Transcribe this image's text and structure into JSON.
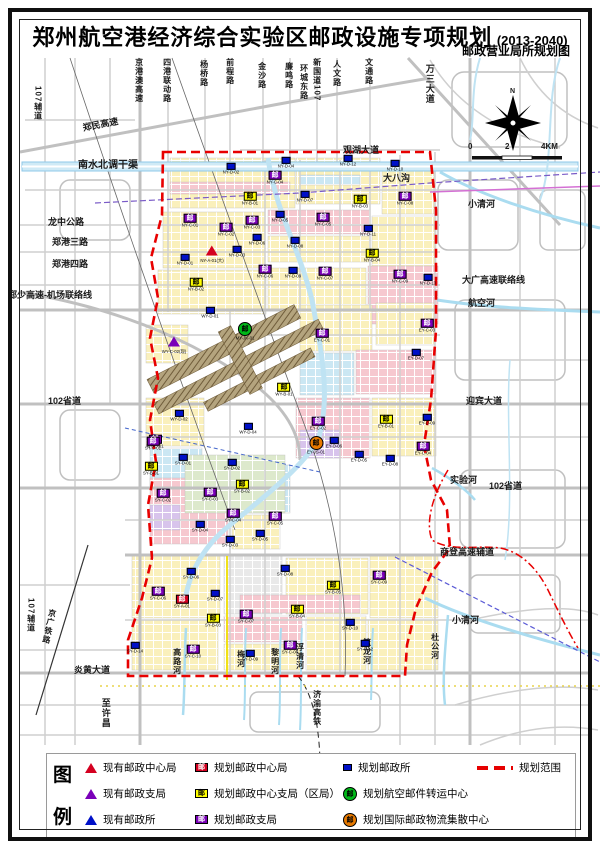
{
  "page": {
    "title": "郑州航空港经济综合实验区邮政设施专项规划",
    "title_years": "(2013-2040)",
    "subtitle": "邮政营业局所规划图"
  },
  "compass": {
    "north_label": "N"
  },
  "scale_bar": {
    "labels": [
      "0",
      "2",
      "4KM"
    ]
  },
  "colors": {
    "existing_center": "#d40020",
    "existing_branch": "#7a00b8",
    "existing_office": "#0010c8",
    "planned_center": "#d40020",
    "planned_district_branch": "#ffff00",
    "planned_branch": "#7a00b8",
    "planned_office": "#0010c8",
    "air_mail_center": "#00b818",
    "intl_logistics_center": "#e87a00",
    "planning_boundary": "#e80000",
    "water": "#aadcf0",
    "road": "#cccccc",
    "parcel_yellow": "#faf0bc",
    "parcel_pink": "#f6c8cf",
    "parcel_blue": "#cbe7f3",
    "runway": "#a4906a"
  },
  "map": {
    "marker_glyph": "邮",
    "labels": [
      {
        "text": "107辅道",
        "x": 33,
        "y": 86,
        "o": "v",
        "s": 8
      },
      {
        "text": "郑民高速",
        "x": 82,
        "y": 124,
        "a": -11
      },
      {
        "text": "京港澳高速",
        "x": 134,
        "y": 58,
        "o": "v",
        "s": 8
      },
      {
        "text": "四港联动路",
        "x": 162,
        "y": 58,
        "o": "v",
        "s": 8
      },
      {
        "text": "杨桥路",
        "x": 199,
        "y": 60,
        "o": "v",
        "s": 8
      },
      {
        "text": "前程路",
        "x": 225,
        "y": 58,
        "o": "v",
        "s": 8
      },
      {
        "text": "金沙路",
        "x": 257,
        "y": 62,
        "o": "v",
        "s": 8
      },
      {
        "text": "廉鸣路",
        "x": 284,
        "y": 62,
        "o": "v",
        "s": 8
      },
      {
        "text": "环城东路",
        "x": 299,
        "y": 64,
        "o": "v",
        "s": 8
      },
      {
        "text": "新国道107",
        "x": 312,
        "y": 58,
        "o": "v",
        "s": 8
      },
      {
        "text": "人文路",
        "x": 332,
        "y": 60,
        "o": "v",
        "s": 8
      },
      {
        "text": "文通路",
        "x": 364,
        "y": 58,
        "o": "v",
        "s": 8
      },
      {
        "text": "万三大道",
        "x": 424,
        "y": 64,
        "o": "v",
        "s": 9
      },
      {
        "text": "南水北调干渠",
        "x": 78,
        "y": 161,
        "s": 10
      },
      {
        "text": "观湖大道",
        "x": 343,
        "y": 146
      },
      {
        "text": "大八沟",
        "x": 383,
        "y": 174
      },
      {
        "text": "小清河",
        "x": 468,
        "y": 200
      },
      {
        "text": "龙中公路",
        "x": 48,
        "y": 218
      },
      {
        "text": "郑港三路",
        "x": 52,
        "y": 238
      },
      {
        "text": "郑港四路",
        "x": 52,
        "y": 260
      },
      {
        "text": "郑少高速-机场联络线",
        "x": 8,
        "y": 291
      },
      {
        "text": "大广高速联络线",
        "x": 462,
        "y": 276
      },
      {
        "text": "航空河",
        "x": 468,
        "y": 299
      },
      {
        "text": "102省道",
        "x": 48,
        "y": 397
      },
      {
        "text": "迎宾大道",
        "x": 466,
        "y": 397
      },
      {
        "text": "实验河",
        "x": 450,
        "y": 476
      },
      {
        "text": "102省道",
        "x": 489,
        "y": 482
      },
      {
        "text": "商登高速辅道",
        "x": 440,
        "y": 548
      },
      {
        "text": "小清河",
        "x": 452,
        "y": 616
      },
      {
        "text": "杜公河",
        "x": 430,
        "y": 633,
        "o": "v",
        "s": 8
      },
      {
        "text": "炎黄大道",
        "x": 74,
        "y": 666
      },
      {
        "text": "至许昌",
        "x": 100,
        "y": 698,
        "o": "v",
        "s": 9
      },
      {
        "text": "京广铁路",
        "x": 48,
        "y": 608,
        "o": "v",
        "s": 8,
        "a": 12
      },
      {
        "text": "107辅道",
        "x": 26,
        "y": 598,
        "o": "v",
        "s": 8
      },
      {
        "text": "高路河",
        "x": 172,
        "y": 648,
        "o": "v",
        "s": 8
      },
      {
        "text": "梅河",
        "x": 236,
        "y": 650,
        "o": "v",
        "s": 8
      },
      {
        "text": "黎明河",
        "x": 270,
        "y": 648,
        "o": "v",
        "s": 8
      },
      {
        "text": "浮清河",
        "x": 295,
        "y": 643,
        "o": "v",
        "s": 8
      },
      {
        "text": "篮龙河",
        "x": 362,
        "y": 638,
        "o": "v",
        "s": 8
      },
      {
        "text": "济渝高铁",
        "x": 312,
        "y": 690,
        "o": "v",
        "s": 8
      },
      {
        "text": "N",
        "x": 510,
        "y": 88,
        "s": 7
      },
      {
        "text": "0",
        "x": 468,
        "y": 143,
        "s": 8
      },
      {
        "text": "2",
        "x": 505,
        "y": 143,
        "s": 8
      },
      {
        "text": "4KM",
        "x": 541,
        "y": 143,
        "s": 8
      }
    ],
    "markers": [
      {
        "t": "tri-red",
        "code": "NY-A-01(大)",
        "x": 212,
        "y": 256
      },
      {
        "t": "tri-purple",
        "code": "WY-C-02(现)",
        "x": 174,
        "y": 347
      },
      {
        "t": "sq-red",
        "code": "SY-A-01",
        "x": 182,
        "y": 603
      },
      {
        "t": "cir-green",
        "code": "MY-JK-01",
        "x": 245,
        "y": 333
      },
      {
        "t": "cir-orange",
        "code": "EY-JS-01",
        "x": 316,
        "y": 447
      },
      {
        "t": "sq-yellow",
        "code": "NY-B-01",
        "x": 250,
        "y": 200
      },
      {
        "t": "sq-yellow",
        "code": "NY-B-03",
        "x": 360,
        "y": 203
      },
      {
        "t": "sq-yellow",
        "code": "NY-B-02",
        "x": 196,
        "y": 286
      },
      {
        "t": "sq-yellow",
        "code": "NY-B-04",
        "x": 372,
        "y": 257
      },
      {
        "t": "sq-yellow",
        "code": "WY-B-01",
        "x": 284,
        "y": 391
      },
      {
        "t": "sq-yellow",
        "code": "EY-B-01",
        "x": 386,
        "y": 423
      },
      {
        "t": "sq-yellow",
        "code": "SY-B-01",
        "x": 151,
        "y": 470
      },
      {
        "t": "sq-yellow",
        "code": "SY-B-02",
        "x": 242,
        "y": 488
      },
      {
        "t": "sq-yellow",
        "code": "SY-B-03",
        "x": 213,
        "y": 622
      },
      {
        "t": "sq-yellow",
        "code": "SY-B-04",
        "x": 297,
        "y": 613
      },
      {
        "t": "sq-yellow",
        "code": "SY-B-05",
        "x": 333,
        "y": 589
      },
      {
        "t": "sq-purple",
        "code": "NY-C-01",
        "x": 190,
        "y": 222
      },
      {
        "t": "sq-purple",
        "code": "NY-C-02",
        "x": 226,
        "y": 231
      },
      {
        "t": "sq-purple",
        "code": "NY-C-03",
        "x": 252,
        "y": 224
      },
      {
        "t": "sq-purple",
        "code": "NY-C-04",
        "x": 275,
        "y": 179
      },
      {
        "t": "sq-purple",
        "code": "NY-C-05",
        "x": 323,
        "y": 221
      },
      {
        "t": "sq-purple",
        "code": "NY-C-06",
        "x": 265,
        "y": 273
      },
      {
        "t": "sq-purple",
        "code": "NY-C-07",
        "x": 325,
        "y": 275
      },
      {
        "t": "sq-purple",
        "code": "NY-C-08",
        "x": 405,
        "y": 200
      },
      {
        "t": "sq-purple",
        "code": "NY-C-09",
        "x": 400,
        "y": 278
      },
      {
        "t": "sq-purple",
        "code": "WY-C-01",
        "x": 155,
        "y": 443
      },
      {
        "t": "sq-purple",
        "code": "EY-C-01",
        "x": 322,
        "y": 337
      },
      {
        "t": "sq-purple",
        "code": "EY-C-02",
        "x": 318,
        "y": 425
      },
      {
        "t": "sq-purple",
        "code": "EY-C-03",
        "x": 427,
        "y": 327
      },
      {
        "t": "sq-purple",
        "code": "EY-C-04",
        "x": 423,
        "y": 450
      },
      {
        "t": "sq-purple",
        "code": "SY-C-01",
        "x": 153,
        "y": 445
      },
      {
        "t": "sq-purple",
        "code": "SY-C-02",
        "x": 163,
        "y": 497
      },
      {
        "t": "sq-purple",
        "code": "SY-C-03",
        "x": 210,
        "y": 496
      },
      {
        "t": "sq-purple",
        "code": "SY-C-04",
        "x": 233,
        "y": 517
      },
      {
        "t": "sq-purple",
        "code": "SY-C-05",
        "x": 275,
        "y": 520
      },
      {
        "t": "sq-purple",
        "code": "SY-C-06",
        "x": 158,
        "y": 595
      },
      {
        "t": "sq-purple",
        "code": "SY-C-07",
        "x": 246,
        "y": 618
      },
      {
        "t": "sq-purple",
        "code": "SY-C-08",
        "x": 290,
        "y": 649
      },
      {
        "t": "sq-purple",
        "code": "SY-C-09",
        "x": 379,
        "y": 579
      },
      {
        "t": "sq-purple",
        "code": "SY-C-10",
        "x": 193,
        "y": 653
      },
      {
        "t": "sq-blue",
        "code": "NY-D-01",
        "x": 185,
        "y": 261
      },
      {
        "t": "sq-blue",
        "code": "NY-D-02",
        "x": 231,
        "y": 170
      },
      {
        "t": "sq-blue",
        "code": "NY-D-03",
        "x": 237,
        "y": 253
      },
      {
        "t": "sq-blue",
        "code": "NY-D-04",
        "x": 286,
        "y": 164
      },
      {
        "t": "sq-blue",
        "code": "NY-D-05",
        "x": 280,
        "y": 218
      },
      {
        "t": "sq-blue",
        "code": "NY-D-06",
        "x": 257,
        "y": 241
      },
      {
        "t": "sq-blue",
        "code": "NY-D-07",
        "x": 305,
        "y": 198
      },
      {
        "t": "sq-blue",
        "code": "NY-D-08",
        "x": 295,
        "y": 244
      },
      {
        "t": "sq-blue",
        "code": "NY-D-09",
        "x": 293,
        "y": 274
      },
      {
        "t": "sq-blue",
        "code": "NY-D-10",
        "x": 395,
        "y": 167
      },
      {
        "t": "sq-blue",
        "code": "NY-D-11",
        "x": 368,
        "y": 232
      },
      {
        "t": "sq-blue",
        "code": "NY-D-12",
        "x": 348,
        "y": 162
      },
      {
        "t": "sq-blue",
        "code": "NY-D-13",
        "x": 428,
        "y": 281
      },
      {
        "t": "sq-blue",
        "code": "WY-D-01",
        "x": 210,
        "y": 314
      },
      {
        "t": "sq-blue",
        "code": "WY-D-02",
        "x": 179,
        "y": 417
      },
      {
        "t": "sq-blue",
        "code": "WY-D-04",
        "x": 248,
        "y": 430
      },
      {
        "t": "sq-blue",
        "code": "EY-D-05",
        "x": 359,
        "y": 458
      },
      {
        "t": "sq-blue",
        "code": "EY-D-06",
        "x": 334,
        "y": 444
      },
      {
        "t": "sq-blue",
        "code": "EY-D-07",
        "x": 416,
        "y": 356
      },
      {
        "t": "sq-blue",
        "code": "EY-D-08",
        "x": 390,
        "y": 462
      },
      {
        "t": "sq-blue",
        "code": "EY-D-09",
        "x": 427,
        "y": 421
      },
      {
        "t": "sq-blue",
        "code": "SY-D-01",
        "x": 183,
        "y": 461
      },
      {
        "t": "sq-blue",
        "code": "SY-D-02",
        "x": 232,
        "y": 466
      },
      {
        "t": "sq-blue",
        "code": "SY-D-03",
        "x": 230,
        "y": 543
      },
      {
        "t": "sq-blue",
        "code": "SY-D-04",
        "x": 200,
        "y": 528
      },
      {
        "t": "sq-blue",
        "code": "SY-D-05",
        "x": 260,
        "y": 537
      },
      {
        "t": "sq-blue",
        "code": "SY-D-06",
        "x": 191,
        "y": 575
      },
      {
        "t": "sq-blue",
        "code": "SY-D-07",
        "x": 215,
        "y": 597
      },
      {
        "t": "sq-blue",
        "code": "SY-D-08",
        "x": 285,
        "y": 572
      },
      {
        "t": "sq-blue",
        "code": "SY-D-09",
        "x": 250,
        "y": 657
      },
      {
        "t": "sq-blue",
        "code": "SY-D-10",
        "x": 350,
        "y": 626
      },
      {
        "t": "sq-blue",
        "code": "SY-D-12",
        "x": 365,
        "y": 647
      },
      {
        "t": "sq-blue",
        "code": "SY-D-14",
        "x": 135,
        "y": 649
      }
    ]
  },
  "legend": {
    "panel_chars": [
      "图",
      "例"
    ],
    "columns": [
      [
        {
          "symbol": "tri-red",
          "label": "现有邮政中心局"
        },
        {
          "symbol": "tri-purple",
          "label": "现有邮政支局"
        },
        {
          "symbol": "tri-blue",
          "label": "现有邮政所"
        }
      ],
      [
        {
          "symbol": "sq-red",
          "label": "规划邮政中心局"
        },
        {
          "symbol": "sq-yellow",
          "label": "规划邮政中心支局（区局）"
        },
        {
          "symbol": "sq-purple",
          "label": "规划邮政支局"
        }
      ],
      [
        {
          "symbol": "sq-blue",
          "label": "规划邮政所"
        },
        {
          "symbol": "cir-green",
          "label": "规划航空邮件转运中心"
        },
        {
          "symbol": "cir-orange",
          "label": "规划国际邮政物流集散中心"
        }
      ],
      [
        {
          "symbol": "dash-red",
          "label": "规划范围"
        }
      ]
    ]
  }
}
